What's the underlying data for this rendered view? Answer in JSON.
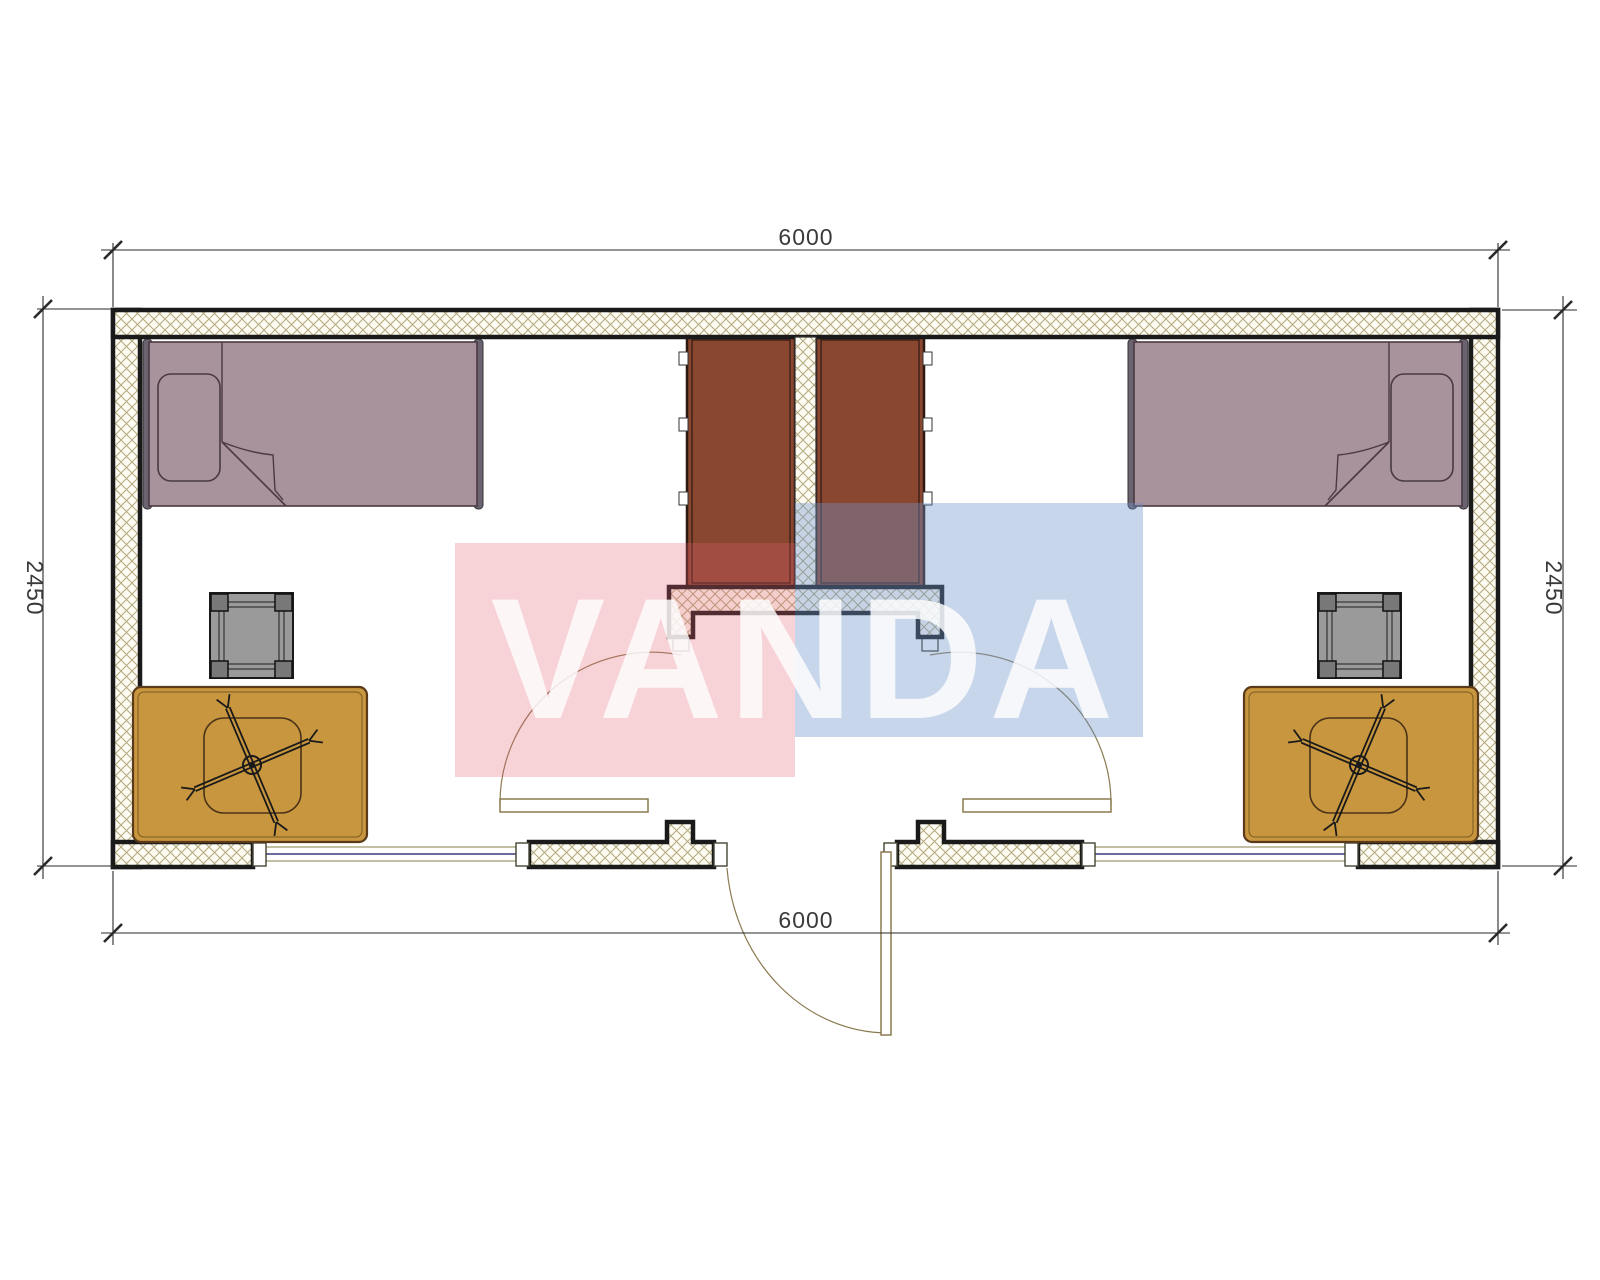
{
  "dimensions": {
    "top": "6000",
    "bottom": "6000",
    "left": "2450",
    "right": "2450"
  },
  "watermark": {
    "text": "VANDA",
    "red_hex": "#e45f6e",
    "blue_hex": "#6f94cc",
    "red_fill": "rgba(228,95,110,0.28)",
    "blue_fill": "rgba(111,148,204,0.38)",
    "text_color": "#ffffff"
  },
  "colors": {
    "wall_outline": "#1a1a1a",
    "hatch_line": "#b3a97e",
    "hatch_bg": "#fdfbf2",
    "bed": "#a8929b",
    "bed_frame": "#6b6370",
    "bed_outline": "#4a3a42",
    "wardrobe": "#8a4730",
    "wardrobe_outline": "#2e1812",
    "desk": "#c8963e",
    "desk_outline": "#5a3a1a",
    "stool": "#9a9a9a",
    "stool_leg": "#787878",
    "window_line": "#3a3a7c",
    "window_frame_outline": "#8a8258",
    "door_line": "#8a7a50",
    "dimension_line": "#2a2a2a",
    "dimension_text": "#3a3a3a"
  },
  "plan": {
    "furniture": [
      "single-bed",
      "wardrobe",
      "square-stool",
      "desk",
      "swivel-chair"
    ],
    "openings": [
      "entrance-door",
      "interior-door-left",
      "interior-door-right",
      "window-left",
      "window-right"
    ]
  }
}
